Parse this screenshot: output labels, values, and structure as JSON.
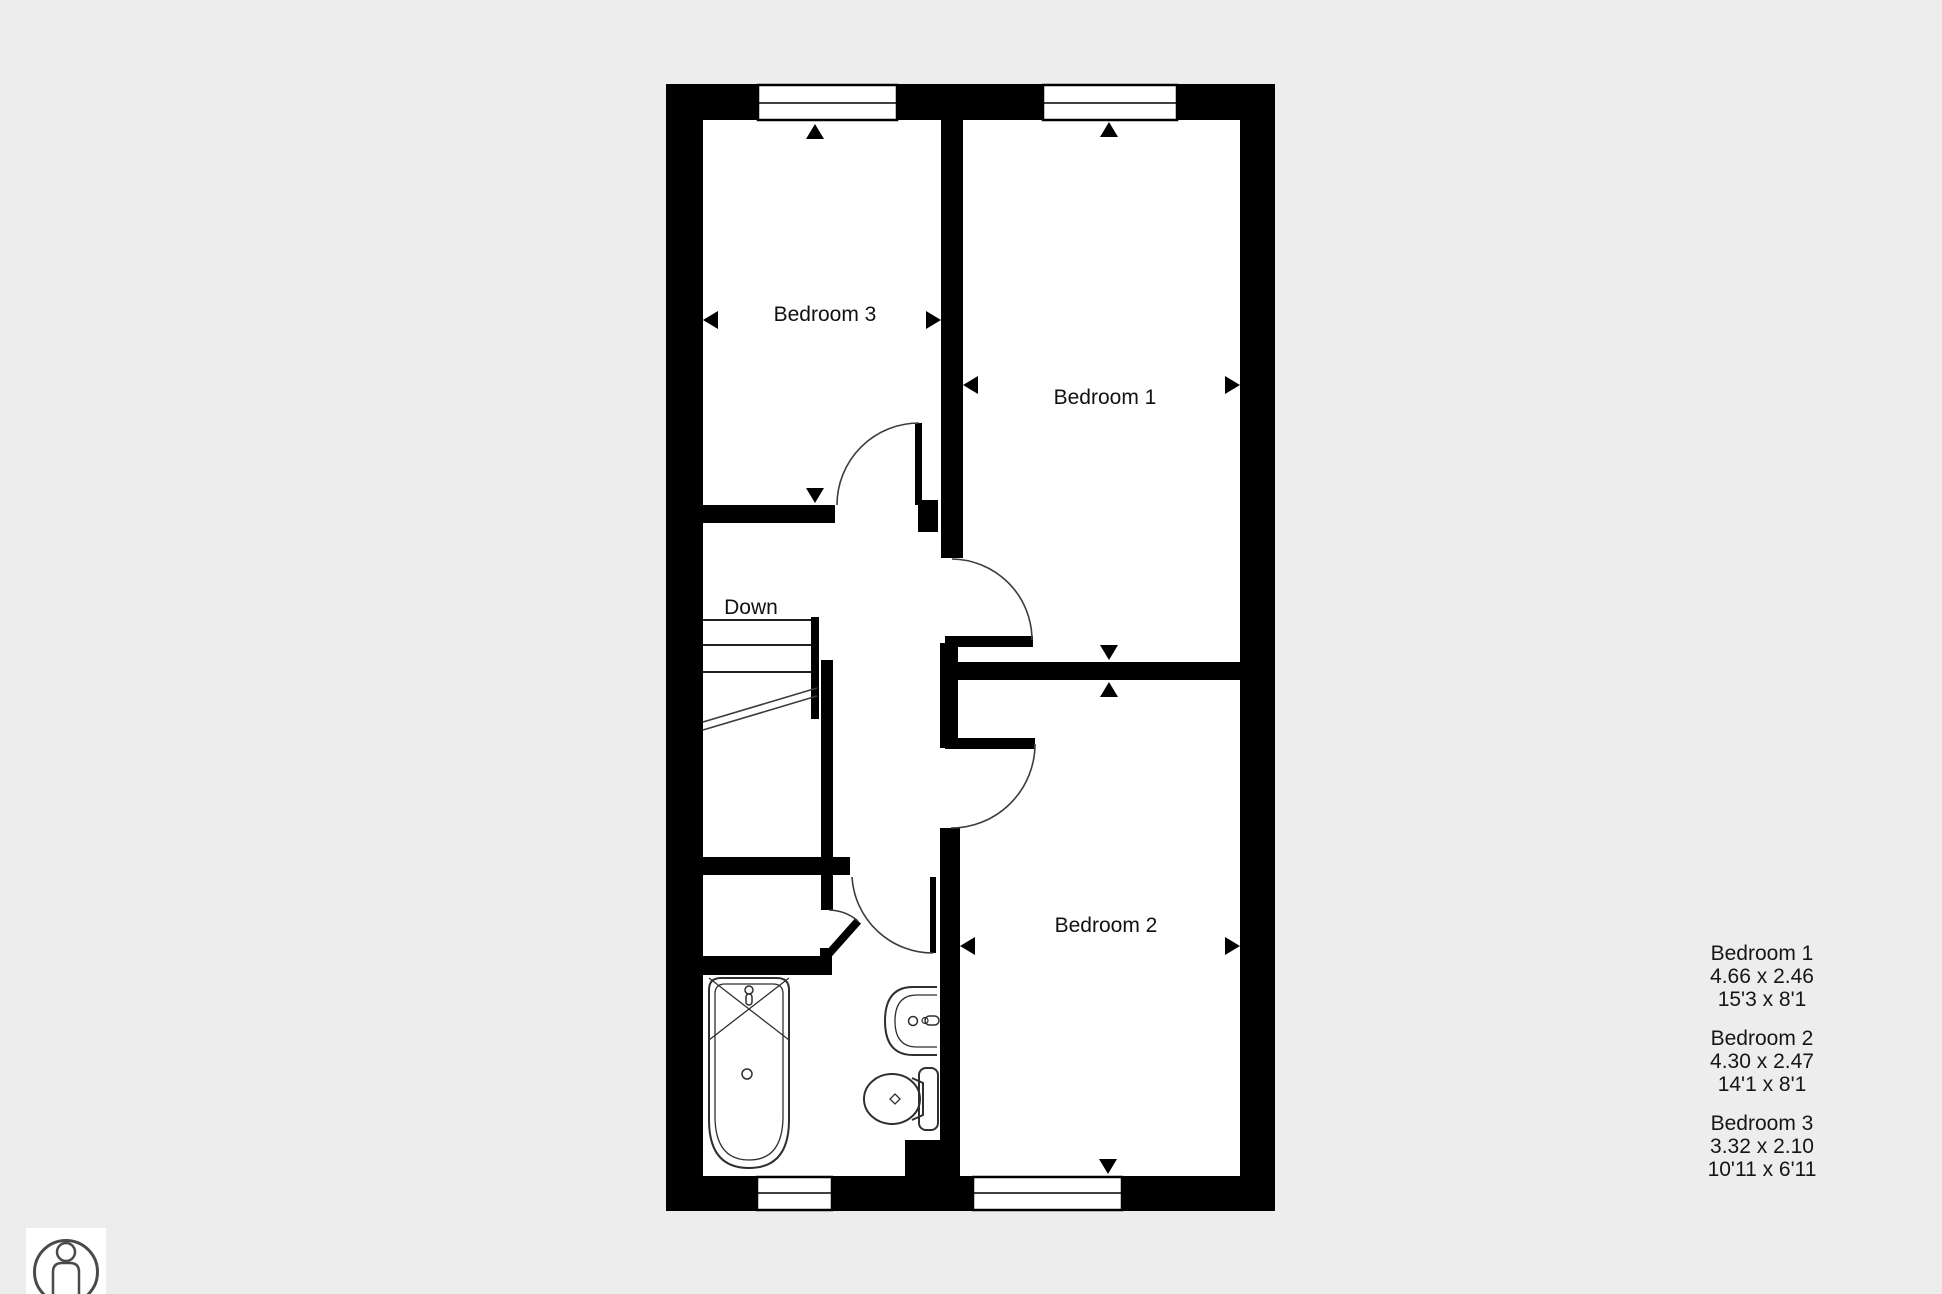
{
  "plan": {
    "rooms": [
      {
        "id": "bedroom-1",
        "label": "Bedroom 1"
      },
      {
        "id": "bedroom-2",
        "label": "Bedroom 2"
      },
      {
        "id": "bedroom-3",
        "label": "Bedroom 3"
      }
    ],
    "stairs_label": "Down"
  },
  "legend": {
    "entries": [
      {
        "name": "Bedroom 1",
        "metric": "4.66 x 2.46",
        "imperial": "15'3 x 8'1"
      },
      {
        "name": "Bedroom 2",
        "metric": "4.30 x 2.47",
        "imperial": "14'1 x 8'1"
      },
      {
        "name": "Bedroom 3",
        "metric": "3.32 x 2.10",
        "imperial": "10'11 x 6'11"
      }
    ]
  },
  "icons": {
    "person_scale": "person-in-circle"
  },
  "colors": {
    "background": "#ededed",
    "wall": "#000000",
    "floor": "#ffffff",
    "line": "#3c3c3c",
    "text": "#161616"
  }
}
